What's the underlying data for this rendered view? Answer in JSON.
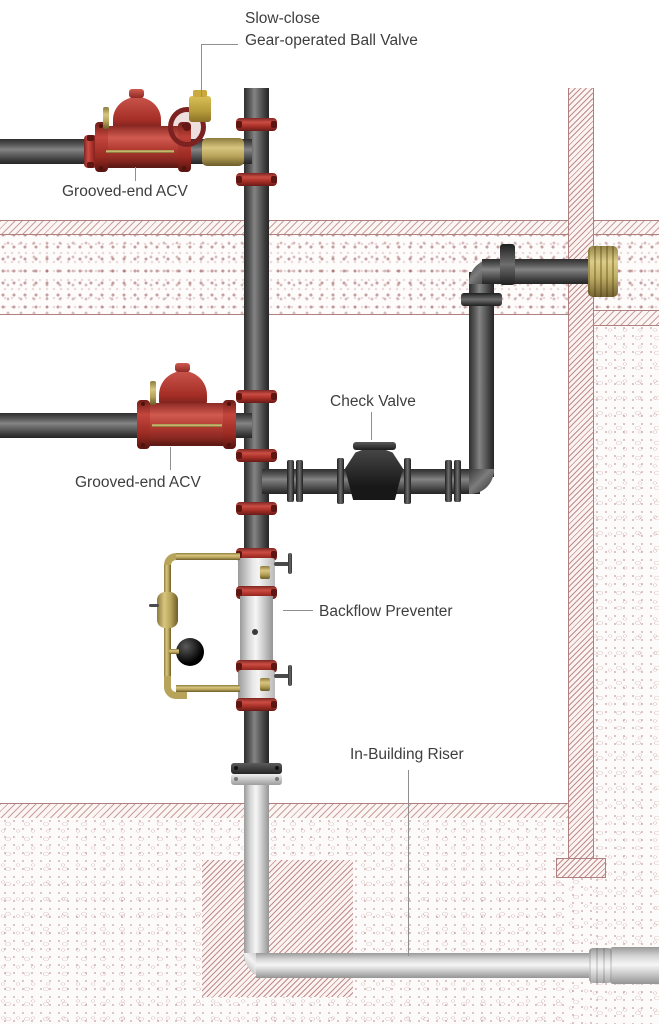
{
  "diagram": {
    "title_implied": "Fire protection riser piping diagram",
    "labels": {
      "ball_valve_line1": "Slow-close",
      "ball_valve_line2": "Gear-operated Ball Valve",
      "acv_top": "Grooved-end ACV",
      "acv_mid": "Grooved-end ACV",
      "check_valve": "Check Valve",
      "backflow": "Backflow Preventer",
      "riser": "In-Building Riser"
    },
    "colors": {
      "valve_red": "#b23a31",
      "coupling_red": "#a93128",
      "pipe_dark": "#565656",
      "pipe_silver": "#d6d6d6",
      "brass": "#c9b86f",
      "check_valve_black": "#222222",
      "texture_red": "#a05656",
      "label_text": "#3e3e3e",
      "leader_gray": "#8f8f8f"
    }
  }
}
